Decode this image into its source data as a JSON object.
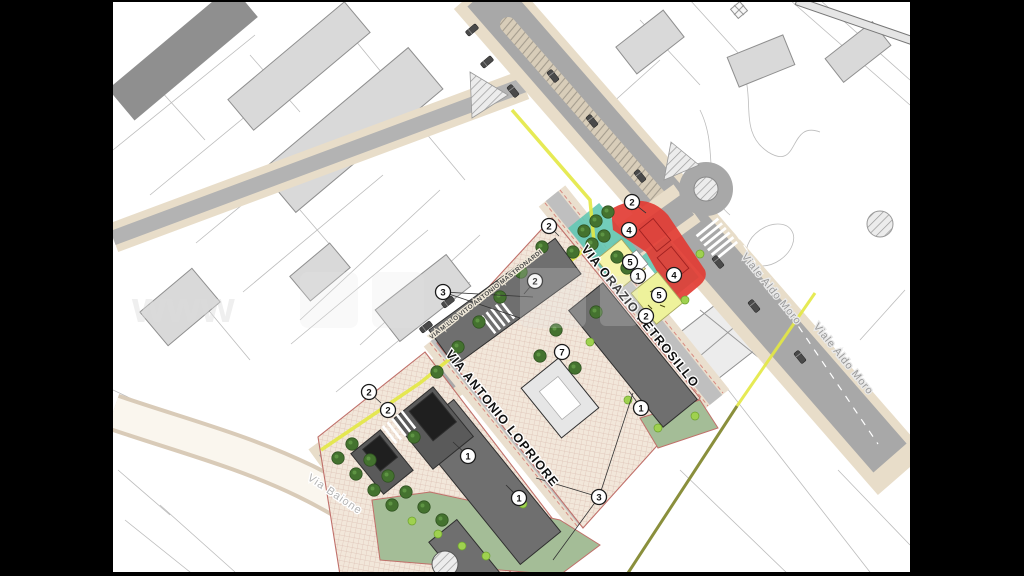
{
  "map": {
    "street_labels": [
      {
        "id": "petrosillo",
        "text": "VIA ORAZIO PETROSILLO",
        "x": 637,
        "y": 319,
        "rotate": 51,
        "size": 12.5,
        "color": "#101010",
        "halo": "#ffffff",
        "weight": "bold",
        "spacing": 1.1
      },
      {
        "id": "lopriore",
        "text": "VIA ANTONIO LOPRIORE",
        "x": 499,
        "y": 421,
        "rotate": 51,
        "size": 12.5,
        "color": "#101010",
        "halo": "#ffffff",
        "weight": "bold",
        "spacing": 1.1
      },
      {
        "id": "mastronardi",
        "text": "VIA M.LLO VITO ANTONIO MASTRONARDI",
        "x": 487,
        "y": 296,
        "rotate": -38,
        "size": 6.3,
        "color": "#4a4a4a",
        "halo": "#efe8d8",
        "weight": "bold",
        "spacing": 0.4
      },
      {
        "id": "baione",
        "text": "Via Baione",
        "x": 333,
        "y": 497,
        "rotate": 34,
        "size": 11,
        "color": "#b3b3b3",
        "halo": "#ffffff",
        "weight": "normal",
        "spacing": 1
      },
      {
        "id": "aldo-moro-1",
        "text": "Viale Aldo Moro",
        "x": 769,
        "y": 291,
        "rotate": 51,
        "size": 10.5,
        "color": "#999999",
        "halo": "#e9e9e9",
        "weight": "normal",
        "spacing": 1
      },
      {
        "id": "aldo-moro-2",
        "text": "Viale Aldo Moro",
        "x": 841,
        "y": 361,
        "rotate": 51,
        "size": 10.5,
        "color": "#999999",
        "halo": "#e9e9e9",
        "weight": "normal",
        "spacing": 1
      }
    ],
    "markers": [
      {
        "n": "2",
        "x": 632,
        "y": 202
      },
      {
        "n": "4",
        "x": 629,
        "y": 230
      },
      {
        "n": "5",
        "x": 630,
        "y": 262
      },
      {
        "n": "1",
        "x": 638,
        "y": 276
      },
      {
        "n": "4",
        "x": 674,
        "y": 275
      },
      {
        "n": "5",
        "x": 659,
        "y": 295
      },
      {
        "n": "2",
        "x": 646,
        "y": 316
      },
      {
        "n": "2",
        "x": 549,
        "y": 226
      },
      {
        "n": "2",
        "x": 535,
        "y": 281
      },
      {
        "n": "3",
        "x": 443,
        "y": 292
      },
      {
        "n": "2",
        "x": 369,
        "y": 392
      },
      {
        "n": "2",
        "x": 388,
        "y": 410
      },
      {
        "n": "7",
        "x": 562,
        "y": 352
      },
      {
        "n": "1",
        "x": 641,
        "y": 408
      },
      {
        "n": "1",
        "x": 468,
        "y": 456
      },
      {
        "n": "1",
        "x": 519,
        "y": 498
      },
      {
        "n": "3",
        "x": 599,
        "y": 497
      }
    ],
    "leader_lines": [
      [
        443,
        292,
        520,
        318
      ],
      [
        443,
        292,
        533,
        297
      ],
      [
        632,
        202,
        646,
        213
      ],
      [
        599,
        497,
        536,
        478
      ],
      [
        599,
        497,
        553,
        560
      ],
      [
        599,
        497,
        633,
        393
      ],
      [
        369,
        392,
        381,
        403
      ],
      [
        641,
        408,
        629,
        391
      ],
      [
        468,
        456,
        453,
        442
      ],
      [
        519,
        498,
        506,
        485
      ],
      [
        549,
        226,
        559,
        236
      ],
      [
        535,
        281,
        524,
        294
      ]
    ],
    "trees": {
      "dark": [
        [
          437,
          372
        ],
        [
          458,
          347
        ],
        [
          479,
          322
        ],
        [
          500,
          297
        ],
        [
          521,
          272
        ],
        [
          542,
          247
        ],
        [
          584,
          231
        ],
        [
          596,
          221
        ],
        [
          608,
          212
        ],
        [
          592,
          244
        ],
        [
          573,
          252
        ],
        [
          604,
          236
        ],
        [
          617,
          257
        ],
        [
          627,
          268
        ],
        [
          556,
          330
        ],
        [
          540,
          356
        ],
        [
          575,
          368
        ],
        [
          596,
          312
        ],
        [
          352,
          444
        ],
        [
          370,
          460
        ],
        [
          388,
          476
        ],
        [
          406,
          492
        ],
        [
          424,
          507
        ],
        [
          442,
          520
        ],
        [
          338,
          458
        ],
        [
          356,
          474
        ],
        [
          374,
          490
        ],
        [
          392,
          505
        ],
        [
          414,
          437
        ]
      ],
      "lime": [
        [
          590,
          342
        ],
        [
          628,
          400
        ],
        [
          658,
          428
        ],
        [
          412,
          521
        ],
        [
          438,
          534
        ],
        [
          462,
          546
        ],
        [
          486,
          556
        ],
        [
          523,
          504
        ],
        [
          695,
          416
        ],
        [
          700,
          254
        ],
        [
          685,
          300
        ]
      ]
    },
    "cars": [
      [
        472,
        30,
        -40
      ],
      [
        487,
        62,
        -40
      ],
      [
        513,
        91,
        51
      ],
      [
        553,
        76,
        51
      ],
      [
        592,
        121,
        51
      ],
      [
        640,
        176,
        51
      ],
      [
        718,
        262,
        51
      ],
      [
        754,
        306,
        51
      ],
      [
        800,
        357,
        51
      ],
      [
        448,
        302,
        -38
      ],
      [
        426,
        327,
        -38
      ]
    ],
    "watermark": {
      "text": "www"
    },
    "colors": {
      "background": "#ffffff",
      "letterbox": "#000000",
      "road": "#a8a8a8",
      "road_minor": "#bdbdbd",
      "sidewalk": "#e8ddc9",
      "median": "#d8cdb9",
      "building_existing": "#d9d9d9",
      "building_existing_dark": "#8f8f8f",
      "building_new": "#6f6f6f",
      "roof_dark": "#1f1f1f",
      "zone_red": "#e23c34",
      "zone_teal": "#63c8b4",
      "zone_yellow": "#f6f4a9",
      "zone_yellow2": "#eef29b",
      "lawn": "#a4bd97",
      "tree_dark": "#44722f",
      "tree_lime": "#9fd14f",
      "boundary_yellow": "#e3e842",
      "boundary_olive": "#8a8f3c",
      "lot_line_red": "#c0504d",
      "parcel_line": "#b5b5b5"
    }
  }
}
